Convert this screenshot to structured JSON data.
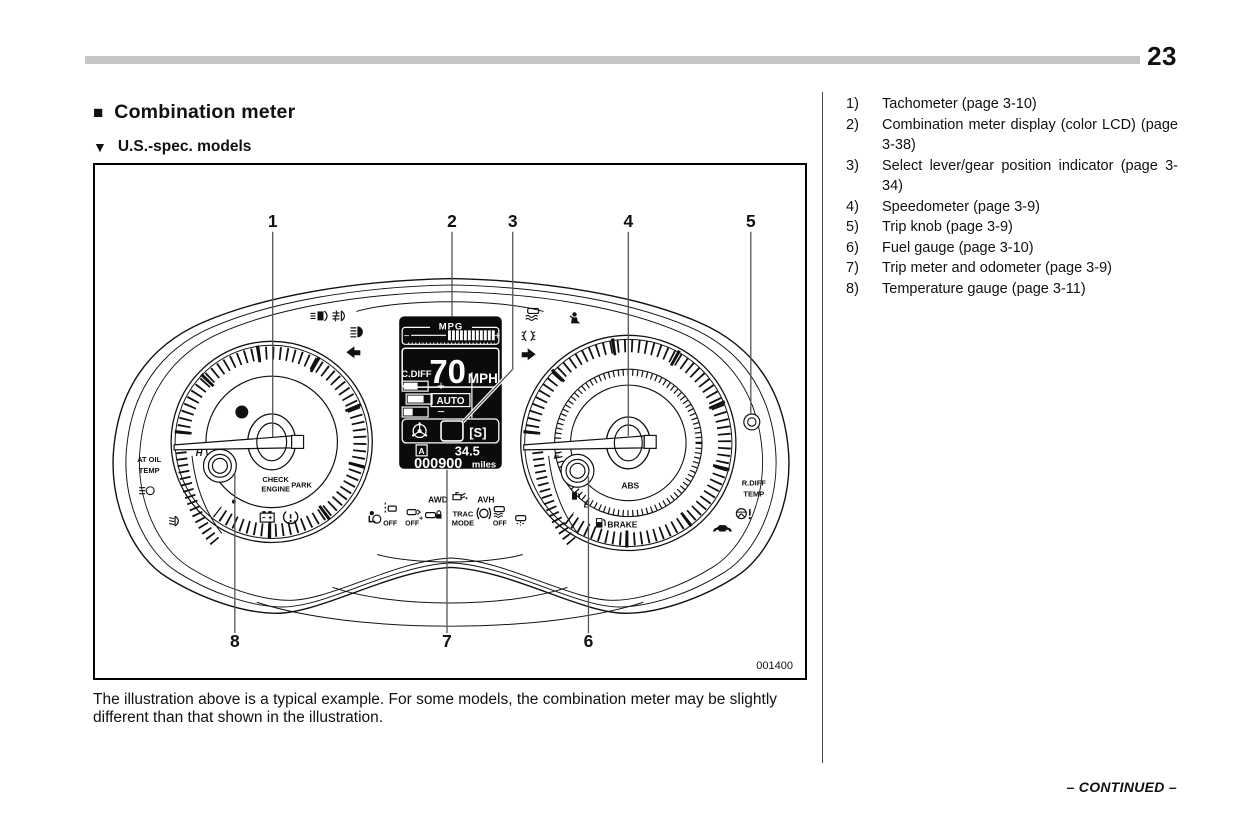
{
  "page": {
    "number": "23",
    "continued": "– CONTINUED –"
  },
  "icons": {
    "section_bullet": "■",
    "subsection_triangle": "▼"
  },
  "section": {
    "title": "Combination meter",
    "subtitle": "U.S.-spec. models"
  },
  "figure": {
    "code": "001400",
    "caption": "The illustration above is a typical example. For some models, the combination meter may be slightly different than that shown in the illustration.",
    "callouts": {
      "c1": "1",
      "c2": "2",
      "c3": "3",
      "c4": "4",
      "c5": "5",
      "c6": "6",
      "c7": "7",
      "c8": "8"
    },
    "lcd": {
      "mpg": "MPG",
      "minus": "−",
      "plus": "+",
      "speed": "70",
      "speed_unit": "MPH",
      "cdiff": "C.DIFF",
      "cdiff_plus": "+",
      "cdiff_auto": "AUTO",
      "cdiff_minus": "−",
      "gear": "[S]",
      "trip_label": "A",
      "trip_value": "34.5",
      "odometer": "000900",
      "odometer_unit": "miles"
    },
    "labels": {
      "at_oil_1": "AT OIL",
      "at_oil_2": "TEMP",
      "h": "H",
      "check_1": "CHECK",
      "check_2": "ENGINE",
      "park": "PARK",
      "awd": "AWD",
      "avh": "AVH",
      "trac_1": "TRAC",
      "trac_2": "MODE",
      "off": "OFF",
      "sway_plus": "+",
      "f": "F",
      "e": "E",
      "abs": "ABS",
      "brake": "BRAKE",
      "rdiff_1": "R.DIFF",
      "rdiff_2": "TEMP"
    }
  },
  "legend": {
    "items": [
      {
        "num": "1)",
        "label": "Tachometer (page 3-10)"
      },
      {
        "num": "2)",
        "label": "Combination meter display (color LCD) (page 3-38)"
      },
      {
        "num": "3)",
        "label": "Select lever/gear position indicator (page 3-34)"
      },
      {
        "num": "4)",
        "label": "Speedometer (page 3-9)"
      },
      {
        "num": "5)",
        "label": "Trip knob (page 3-9)"
      },
      {
        "num": "6)",
        "label": "Fuel gauge (page 3-10)"
      },
      {
        "num": "7)",
        "label": "Trip meter and odometer (page 3-9)"
      },
      {
        "num": "8)",
        "label": "Temperature gauge (page 3-11)"
      }
    ]
  }
}
